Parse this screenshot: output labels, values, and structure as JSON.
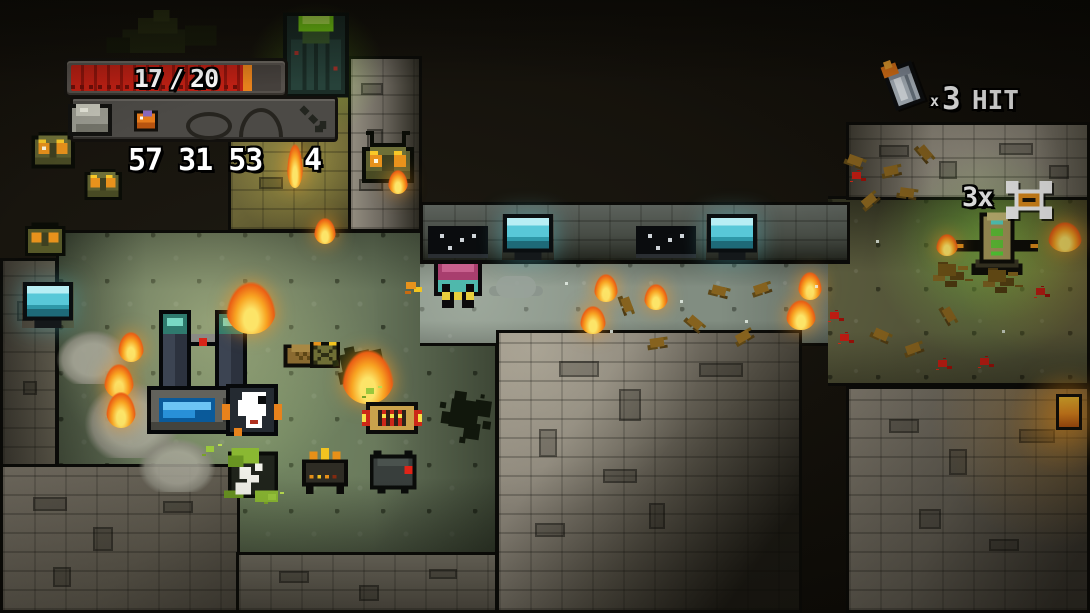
{
  "hud": {
    "health": {
      "current": "17",
      "separator": "/",
      "max": "20",
      "percent": 86
    },
    "inventory": {
      "slots": [
        {
          "name": "rock"
        },
        {
          "name": "orange-tool"
        },
        {
          "name": "empty-oval"
        },
        {
          "name": "empty-dome"
        },
        {
          "name": "aim-arrow"
        }
      ]
    },
    "counters": [
      "57",
      "31",
      "53"
    ],
    "level": "4",
    "hit_indicator": {
      "times_symbol": "x",
      "count": "3",
      "label": "HIT"
    },
    "stack_indicator": {
      "label": "3x"
    }
  },
  "colors": {
    "health_fill": "#c02014",
    "health_cap": "#e8821c",
    "door_lamp": "#8ee418",
    "monitor_screen": "#5ecede",
    "flame": "#f89018",
    "floor_main": "#66745a",
    "wall_gray": "#8b8478",
    "alien_pink": "#a83e6e",
    "slime_green": "#8ab832",
    "accent_orange": "#e8921c"
  },
  "scene": {
    "entities": [
      "player",
      "alien-enemy",
      "rat-creature",
      "skeleton-corpse",
      "twin-generator",
      "exit-door",
      "alien-pod",
      "wall-monitor",
      "star-panel",
      "tnt-bundle",
      "grenade-item",
      "supply-crate",
      "detonator-device",
      "shrine",
      "torch-flame",
      "wall-lamp",
      "explosion",
      "debris",
      "blood-splat",
      "rubble",
      "dark-splatter",
      "smoke-puff",
      "wrecked-vehicle"
    ]
  }
}
